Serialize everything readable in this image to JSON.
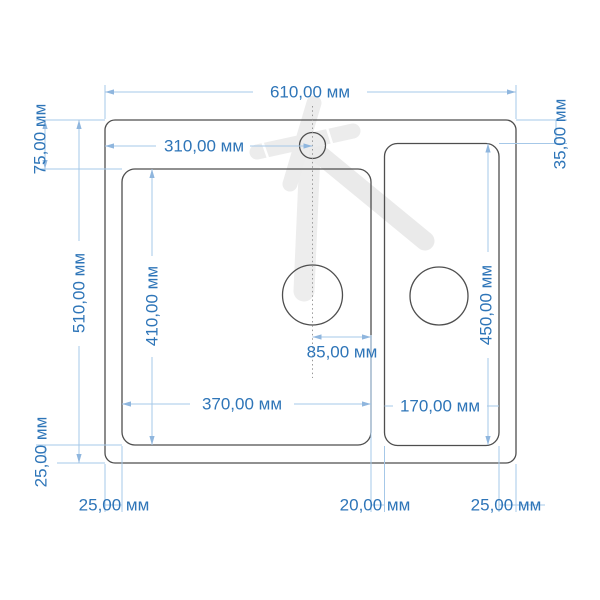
{
  "drawing": {
    "type": "sink-dimension-drawing",
    "unit": "мм"
  },
  "dims": {
    "total_width": {
      "label": "610,00 мм",
      "value_mm": 610
    },
    "faucet_offset": {
      "label": "310,00 мм",
      "value_mm": 310
    },
    "deck_top_right": {
      "label": "35,00 мм",
      "value_mm": 35
    },
    "deck_top_left": {
      "label": "75,00 мм",
      "value_mm": 75
    },
    "total_depth": {
      "label": "510,00 мм",
      "value_mm": 510
    },
    "left_bowl_depth": {
      "label": "410,00 мм",
      "value_mm": 410
    },
    "right_bowl_depth": {
      "label": "450,00 мм",
      "value_mm": 450
    },
    "drain_offset": {
      "label": "85,00 мм",
      "value_mm": 85
    },
    "left_bowl_width": {
      "label": "370,00 мм",
      "value_mm": 370
    },
    "right_bowl_width": {
      "label": "170,00 мм",
      "value_mm": 170
    },
    "margin_bottom": {
      "label": "25,00 мм",
      "value_mm": 25
    },
    "margin_left": {
      "label": "25,00 мм",
      "value_mm": 25
    },
    "bowl_gap": {
      "label": "20,00 мм",
      "value_mm": 20
    },
    "margin_right": {
      "label": "25,00 мм",
      "value_mm": 25
    }
  },
  "colors": {
    "dim_text": "#2e75b8",
    "dim_line": "#a6c8e8",
    "outline": "#4e4e4e",
    "watermark": "#ececec",
    "background": "#ffffff"
  }
}
